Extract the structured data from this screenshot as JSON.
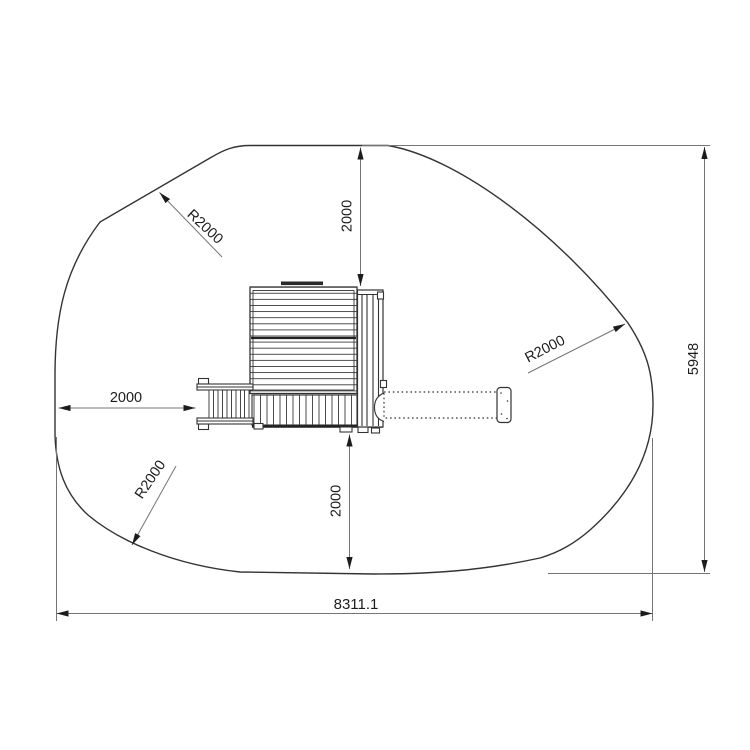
{
  "drawing": {
    "labels": {
      "clearance_top": "2000",
      "clearance_left": "2000",
      "clearance_bottom": "2000",
      "radius_top_left": "R2000",
      "radius_right": "R2000",
      "radius_bottom_left": "R2000",
      "overall_width": "8311.1",
      "overall_height": "5948"
    },
    "colors": {
      "background": "#ffffff",
      "structure_line": "#333333",
      "dimension_line": "#757575",
      "annotation": "#1c1c1c"
    }
  }
}
